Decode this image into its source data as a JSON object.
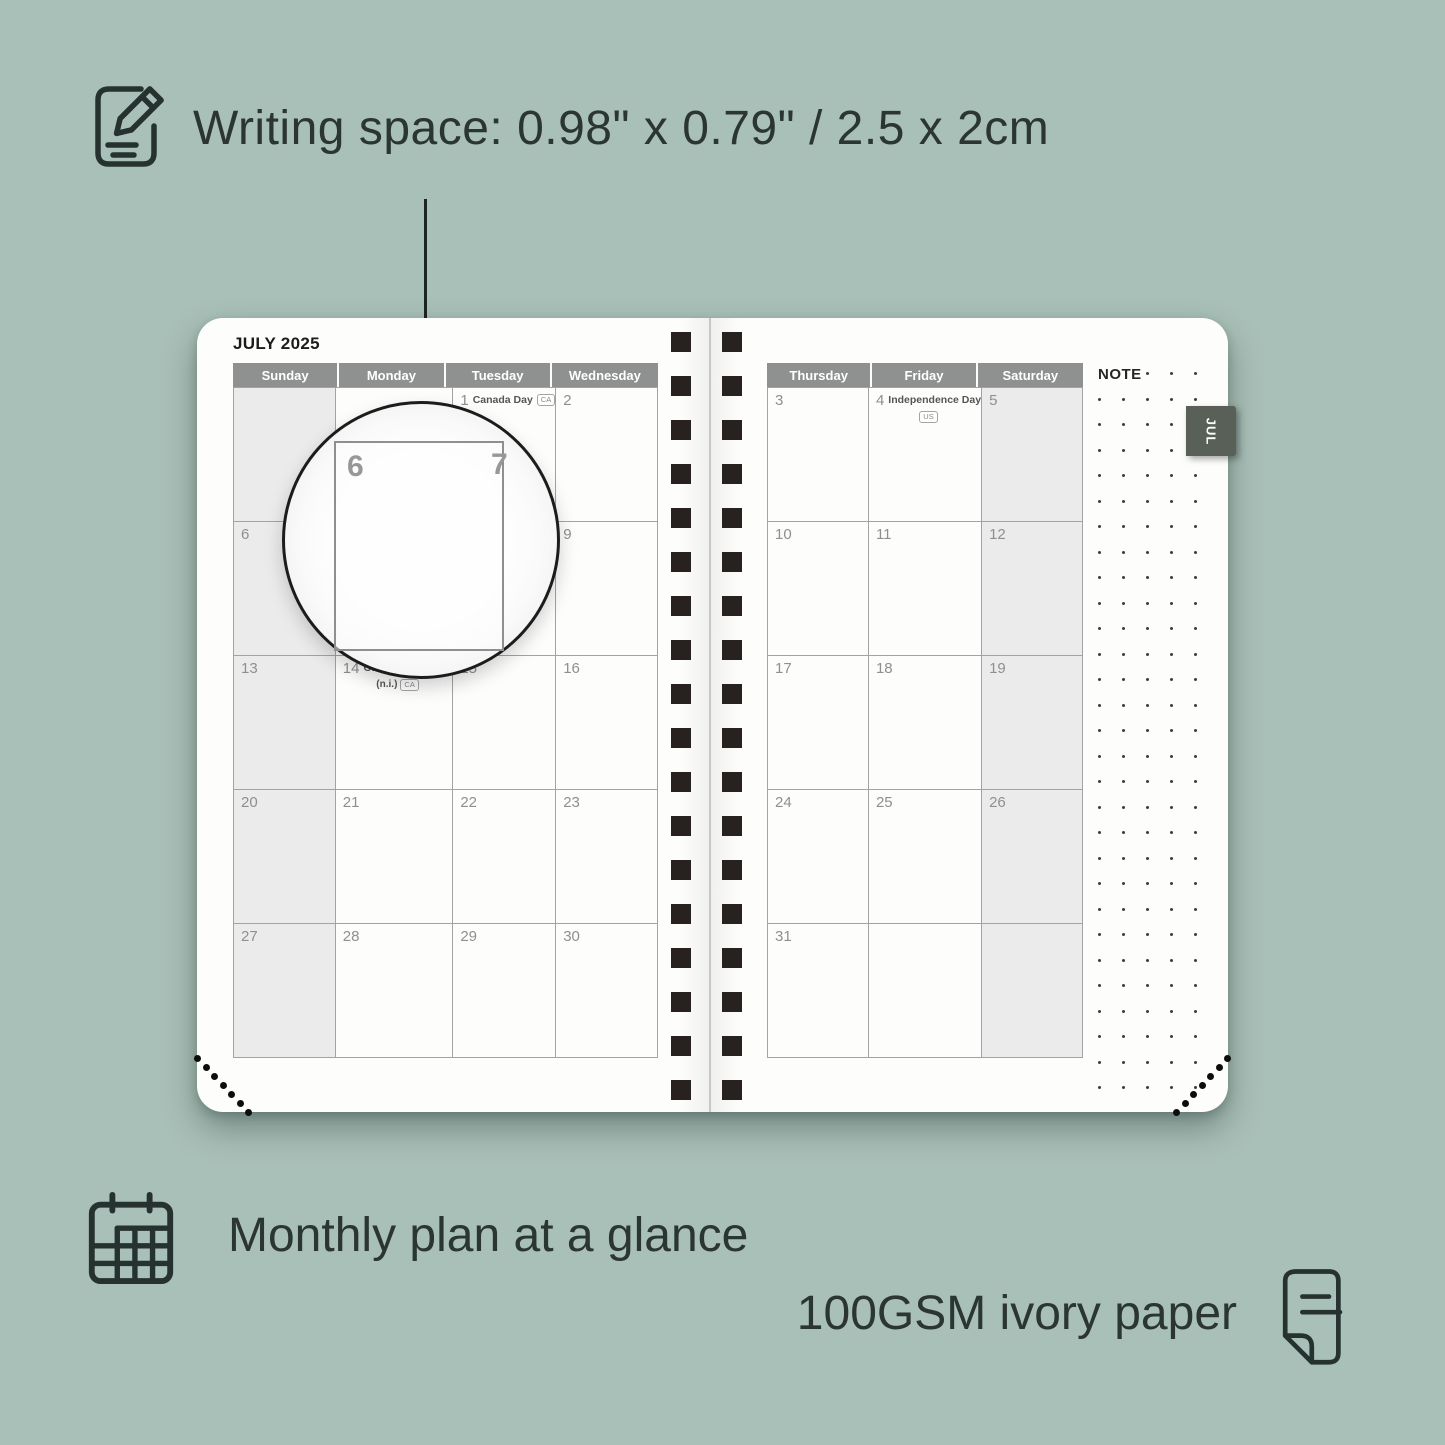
{
  "header": {
    "title": "Writing space: 0.98\" x 0.79\" / 2.5 x 2cm"
  },
  "planner": {
    "month_title": "JULY 2025",
    "tab_label": "JUL",
    "note_label": "NOTE",
    "left_day_headers": [
      "Sunday",
      "Monday",
      "Tuesday",
      "Wednesday"
    ],
    "right_day_headers": [
      "Thursday",
      "Friday",
      "Saturday"
    ],
    "left_weeks": [
      [
        {
          "d": ""
        },
        {
          "d": ""
        },
        {
          "d": "1",
          "holiday": "Canada Day",
          "badge_inline": "CA"
        },
        {
          "d": "2"
        }
      ],
      [
        {
          "d": "6"
        },
        {
          "d": "7"
        },
        {
          "d": "8"
        },
        {
          "d": "9"
        }
      ],
      [
        {
          "d": "13"
        },
        {
          "d": "14",
          "holiday": "Orangemen's Day",
          "sub": "(n.i.)",
          "badge_sub": "CA"
        },
        {
          "d": "15"
        },
        {
          "d": "16"
        }
      ],
      [
        {
          "d": "20"
        },
        {
          "d": "21"
        },
        {
          "d": "22"
        },
        {
          "d": "23"
        }
      ],
      [
        {
          "d": "27"
        },
        {
          "d": "28"
        },
        {
          "d": "29"
        },
        {
          "d": "30"
        }
      ]
    ],
    "right_weeks": [
      [
        {
          "d": "3"
        },
        {
          "d": "4",
          "holiday": "Independence Day",
          "badge_sub": "US"
        },
        {
          "d": "5"
        }
      ],
      [
        {
          "d": "10"
        },
        {
          "d": "11"
        },
        {
          "d": "12"
        }
      ],
      [
        {
          "d": "17"
        },
        {
          "d": "18"
        },
        {
          "d": "19"
        }
      ],
      [
        {
          "d": "24"
        },
        {
          "d": "25"
        },
        {
          "d": "26"
        }
      ],
      [
        {
          "d": "31"
        },
        {
          "d": ""
        },
        {
          "d": ""
        }
      ]
    ],
    "magnifier": {
      "left_date": "6",
      "right_date": "7"
    }
  },
  "footer": {
    "monthly_text": "Monthly plan at a glance",
    "paper_text": "100GSM ivory paper"
  },
  "colors": {
    "bg": "#a9c0b8",
    "ink": "#2b3532",
    "page": "#fdfdfc",
    "header-gray": "#8f9090",
    "weekend": "#ebebeb",
    "grid-line": "#a3a3a3",
    "date-gray": "#8f8f8f",
    "tab-bg": "#596058",
    "spiral": "#272120"
  }
}
